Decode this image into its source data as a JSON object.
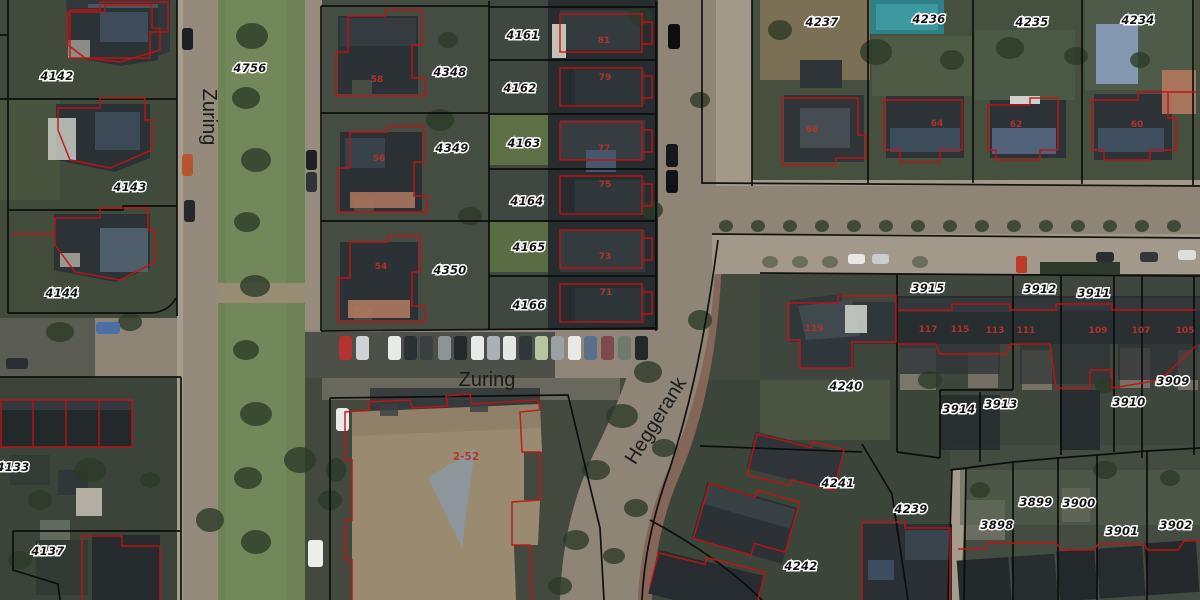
{
  "map": {
    "type": "aerial-cadastral-map",
    "colors": {
      "parcel_boundary": "#0b0b0b",
      "building_outline": "#c31212",
      "parcel_label_text": "#141414",
      "parcel_label_halo": "#ffffff",
      "street_label_text": "#1c1c1c",
      "house_number_text": "#b5342c",
      "pool_teal": "#2f8089",
      "pool_blue": "#8aa0bd"
    },
    "street_labels": [
      {
        "text": "Zuring",
        "x": 203,
        "y": 117,
        "rotation": 90,
        "size": 19
      },
      {
        "text": "Zuring",
        "x": 487,
        "y": 386,
        "rotation": 0,
        "size": 20
      },
      {
        "text": "Heggerank",
        "x": 661,
        "y": 424,
        "rotation": -58,
        "size": 17
      }
    ],
    "parcel_labels": [
      {
        "text": "4142",
        "x": 57,
        "y": 80
      },
      {
        "text": "4143",
        "x": 130,
        "y": 191
      },
      {
        "text": "4144",
        "x": 62,
        "y": 297
      },
      {
        "text": "4756",
        "x": 250,
        "y": 72
      },
      {
        "text": "4348",
        "x": 450,
        "y": 76
      },
      {
        "text": "4349",
        "x": 452,
        "y": 152
      },
      {
        "text": "4350",
        "x": 450,
        "y": 274
      },
      {
        "text": "4161",
        "x": 523,
        "y": 39
      },
      {
        "text": "4162",
        "x": 520,
        "y": 92
      },
      {
        "text": "4163",
        "x": 524,
        "y": 147
      },
      {
        "text": "4164",
        "x": 527,
        "y": 205
      },
      {
        "text": "4165",
        "x": 529,
        "y": 251
      },
      {
        "text": "4166",
        "x": 529,
        "y": 309
      },
      {
        "text": "4237",
        "x": 822,
        "y": 26
      },
      {
        "text": "4236",
        "x": 929,
        "y": 23
      },
      {
        "text": "4235",
        "x": 1032,
        "y": 26
      },
      {
        "text": "4234",
        "x": 1138,
        "y": 24
      },
      {
        "text": "3915",
        "x": 928,
        "y": 292
      },
      {
        "text": "3912",
        "x": 1040,
        "y": 293
      },
      {
        "text": "3911",
        "x": 1094,
        "y": 297
      },
      {
        "text": "3914",
        "x": 959,
        "y": 413
      },
      {
        "text": "3913",
        "x": 1001,
        "y": 408
      },
      {
        "text": "3910",
        "x": 1129,
        "y": 406
      },
      {
        "text": "3909",
        "x": 1173,
        "y": 385
      },
      {
        "text": "4240",
        "x": 846,
        "y": 390
      },
      {
        "text": "4241",
        "x": 838,
        "y": 487
      },
      {
        "text": "4239",
        "x": 911,
        "y": 513
      },
      {
        "text": "4242",
        "x": 801,
        "y": 570
      },
      {
        "text": "4133",
        "x": 13,
        "y": 471
      },
      {
        "text": "4137",
        "x": 48,
        "y": 555
      },
      {
        "text": "3898",
        "x": 997,
        "y": 529
      },
      {
        "text": "3899",
        "x": 1036,
        "y": 506
      },
      {
        "text": "3900",
        "x": 1079,
        "y": 507
      },
      {
        "text": "3901",
        "x": 1122,
        "y": 535
      },
      {
        "text": "3902",
        "x": 1176,
        "y": 529
      }
    ],
    "house_numbers": [
      {
        "text": "58",
        "x": 377,
        "y": 82,
        "big": false
      },
      {
        "text": "56",
        "x": 379,
        "y": 161,
        "big": false
      },
      {
        "text": "54",
        "x": 381,
        "y": 269,
        "big": false
      },
      {
        "text": "2-52",
        "x": 466,
        "y": 460,
        "big": true
      },
      {
        "text": "81",
        "x": 604,
        "y": 43,
        "big": false
      },
      {
        "text": "79",
        "x": 605,
        "y": 80,
        "big": false
      },
      {
        "text": "77",
        "x": 604,
        "y": 151,
        "big": false
      },
      {
        "text": "75",
        "x": 605,
        "y": 187,
        "big": false
      },
      {
        "text": "73",
        "x": 605,
        "y": 259,
        "big": false
      },
      {
        "text": "71",
        "x": 606,
        "y": 295,
        "big": false
      },
      {
        "text": "66",
        "x": 812,
        "y": 132,
        "big": false
      },
      {
        "text": "64",
        "x": 937,
        "y": 126,
        "big": false
      },
      {
        "text": "62",
        "x": 1016,
        "y": 127,
        "big": false
      },
      {
        "text": "60",
        "x": 1137,
        "y": 127,
        "big": false
      },
      {
        "text": "119",
        "x": 814,
        "y": 331,
        "big": false
      },
      {
        "text": "117",
        "x": 928,
        "y": 332,
        "big": false
      },
      {
        "text": "115",
        "x": 960,
        "y": 332,
        "big": false
      },
      {
        "text": "113",
        "x": 995,
        "y": 333,
        "big": false
      },
      {
        "text": "111",
        "x": 1026,
        "y": 333,
        "big": false
      },
      {
        "text": "109",
        "x": 1098,
        "y": 333,
        "big": false
      },
      {
        "text": "107",
        "x": 1141,
        "y": 333,
        "big": false
      },
      {
        "text": "105",
        "x": 1185,
        "y": 333,
        "big": false
      }
    ]
  }
}
